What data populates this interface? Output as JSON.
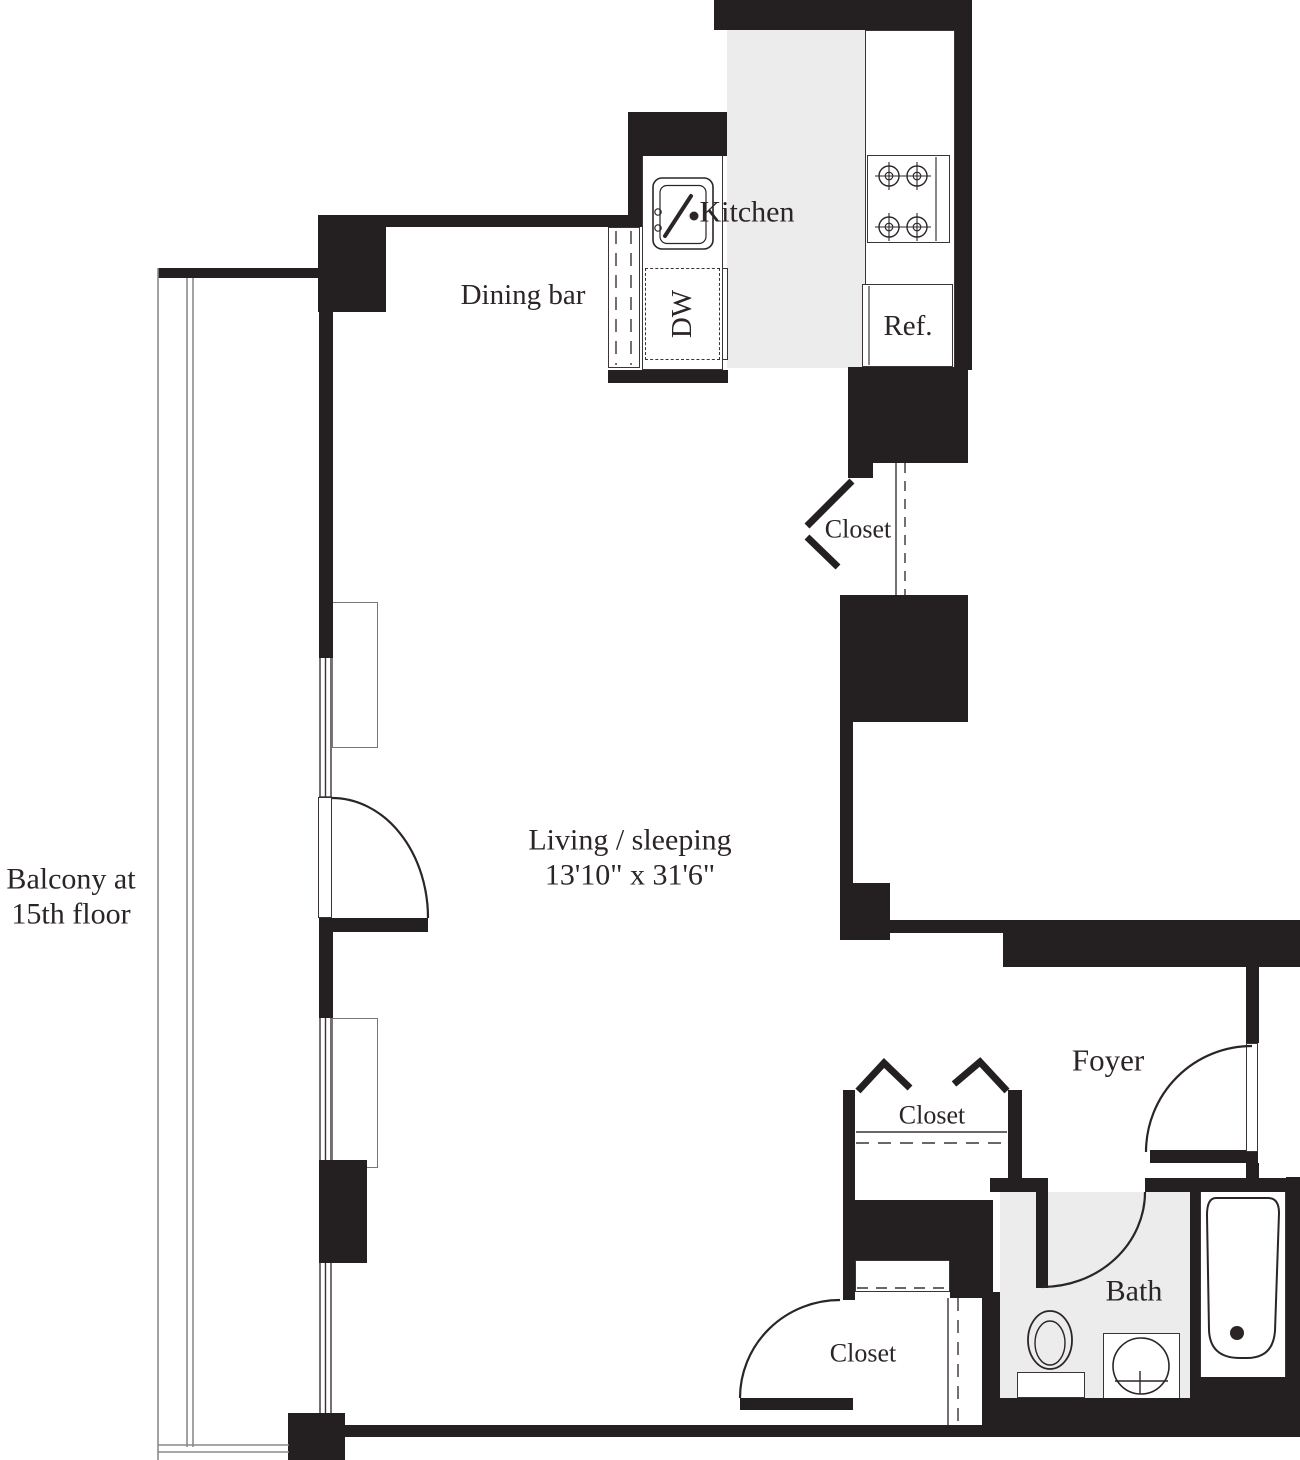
{
  "title": "Studio apartment floor plan",
  "colors": {
    "wall": "#241f20",
    "floor_light": "#ececec",
    "line": "#2b2526",
    "background": "#ffffff"
  },
  "rooms": {
    "balcony": {
      "line1": "Balcony at",
      "line2": "15th floor"
    },
    "dining_bar": {
      "label": "Dining bar"
    },
    "kitchen": {
      "label": "Kitchen"
    },
    "closet_kitchen": {
      "label": "Closet"
    },
    "living": {
      "label": "Living / sleeping",
      "dimensions": "13'10\" x 31'6\""
    },
    "foyer": {
      "label": "Foyer"
    },
    "closet_foyer": {
      "label": "Closet"
    },
    "closet_living": {
      "label": "Closet"
    },
    "bath": {
      "label": "Bath"
    }
  },
  "appliances": {
    "dishwasher": "DW",
    "refrigerator": "Ref."
  }
}
